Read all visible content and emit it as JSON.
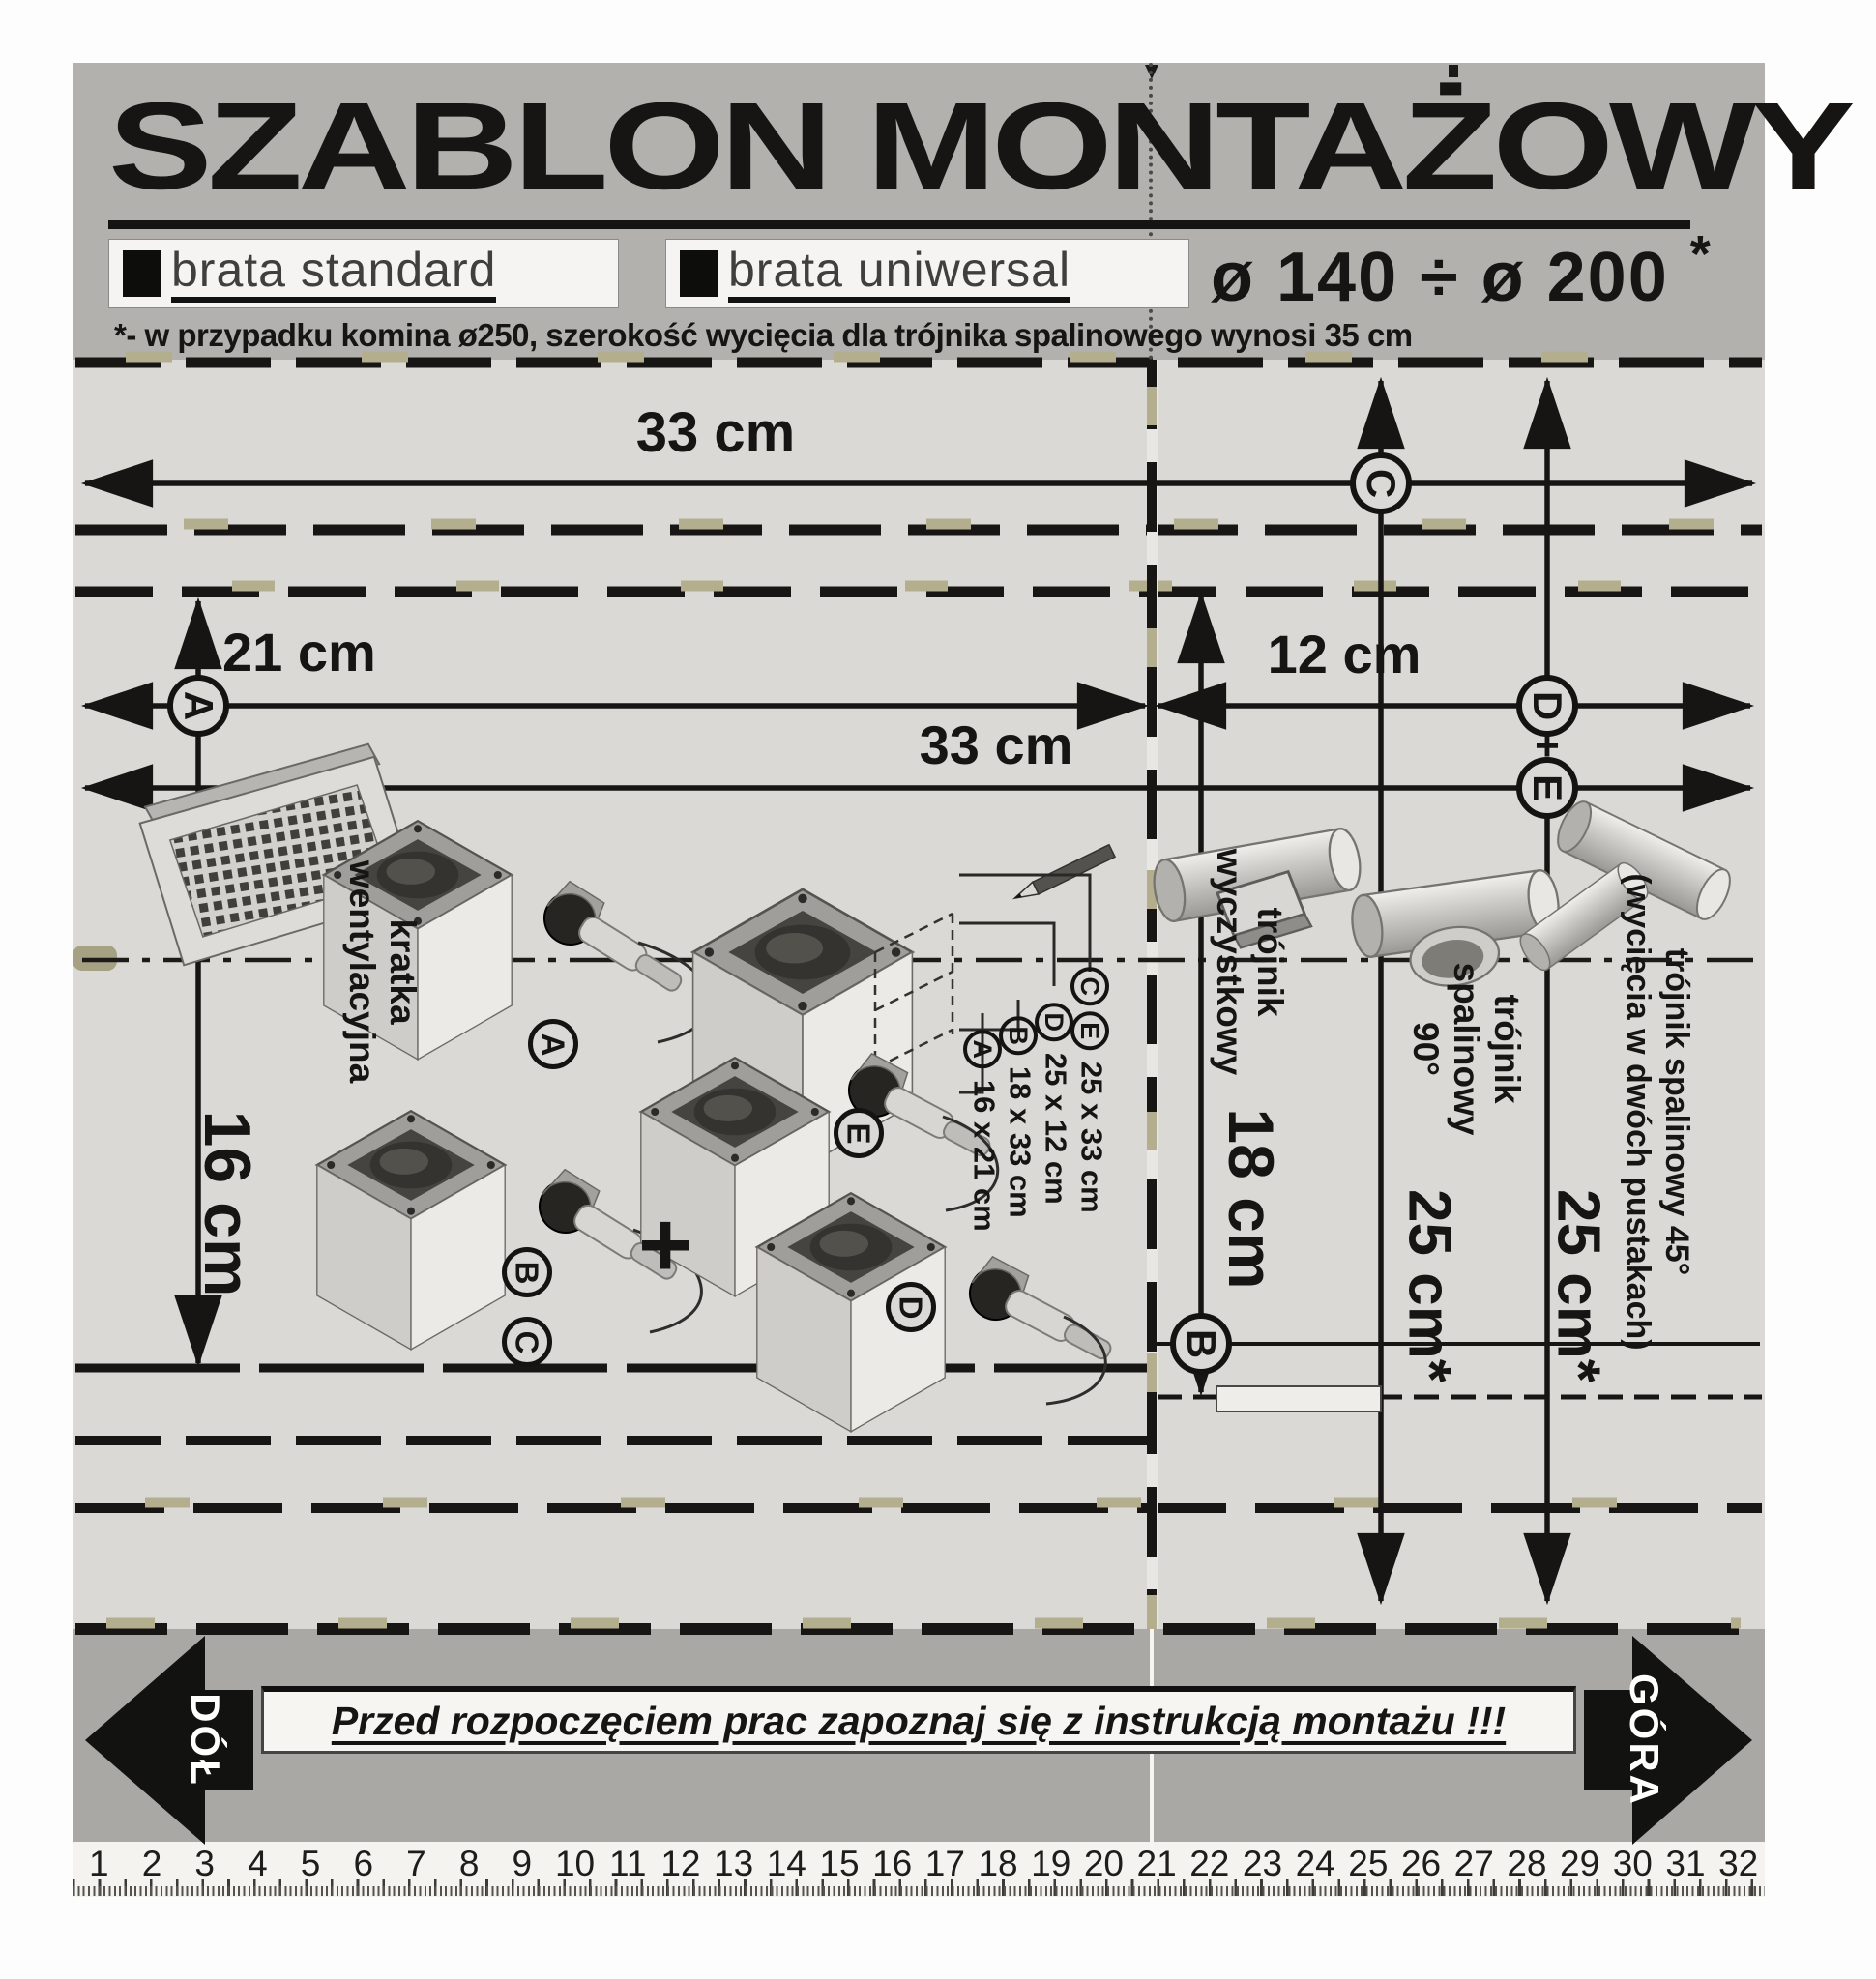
{
  "header": {
    "title": "SZABLON MONTAŻOWY",
    "brand_standard": "brata standard",
    "brand_universal": "brata uniwersal",
    "diameter_range": "ø 140 ÷ ø 200",
    "asterisk": "*",
    "footnote": "*- w przypadku komina ø250, szerokość wycięcia dla trójnika spalinowego wynosi 35 cm"
  },
  "dimensions": {
    "top_width": "33 cm",
    "grille_width": "21 cm",
    "offset_right": "12 cm",
    "mid_width": "33 cm",
    "grille_height": "16 cm",
    "cleanout_height": "18 cm",
    "tee90_height": "25 cm*",
    "tee45_height": "25 cm*",
    "plus": "+"
  },
  "circled": {
    "a": "A",
    "b": "B",
    "c": "C",
    "d": "D",
    "e": "E"
  },
  "labels": {
    "vent_grille": [
      "kratka",
      "wentylacyjna"
    ],
    "cleanout_tee": [
      "trójnik",
      "wyczystkowy"
    ],
    "tee_90": [
      "trójnik",
      "spalinowy",
      "90°"
    ],
    "tee_45": [
      "trójnik spalinowy 45°",
      "(wycięcia w dwóch pustakach)"
    ]
  },
  "cut_sizes": [
    {
      "letters": [
        "C",
        "E"
      ],
      "size": "25 x 33 cm"
    },
    {
      "letters": [
        "D"
      ],
      "size": "25 x 12 cm"
    },
    {
      "letters": [
        "B"
      ],
      "size": "18 x 33 cm"
    },
    {
      "letters": [
        "A"
      ],
      "size": "16 x 21 cm"
    }
  ],
  "footer": {
    "warning": "Przed rozpoczęciem prac zapoznaj się z instrukcją montażu !!!",
    "down_label": "DÓŁ",
    "up_label": "GÓRA"
  },
  "ruler": {
    "numbers": [
      1,
      2,
      3,
      4,
      5,
      6,
      7,
      8,
      9,
      10,
      11,
      12,
      13,
      14,
      15,
      16,
      17,
      18,
      19,
      20,
      21,
      22,
      23,
      24,
      25,
      26,
      27,
      28,
      29,
      30,
      31,
      32
    ]
  },
  "colors": {
    "header_band": "#b2b1ae",
    "panel": "#dbd9d5",
    "footer_band": "#a9a8a5",
    "ink": "#161514",
    "notch": "#b3ae8e",
    "label_box": "#f5f4f2"
  }
}
